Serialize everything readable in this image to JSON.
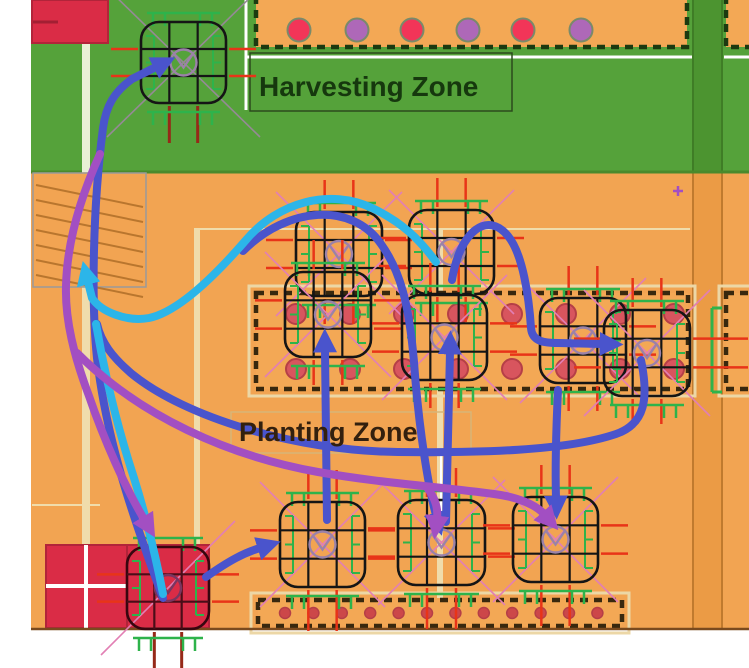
{
  "labels": {
    "harvesting": "Harvesting Zone",
    "planting": "Planting Zone"
  },
  "palette": {
    "white": "#ffffff",
    "green_bg": "#55a23a",
    "orange_bg": "#f2a452",
    "track_green": "#4c9430",
    "track_orange": "#eb9b45",
    "track_edge_green": "#3f7d26",
    "track_edge_orange": "#c07a2e",
    "zone_divider": "#4a8a2c",
    "map_bottom_edge": "#7a4a1e",
    "red_square": "#da2c46",
    "red_square_edge": "#b2243a",
    "red_square_dash": "#a31f33",
    "bed_dash": "#38280e",
    "bed_dash_green": "#1c3a10",
    "bed_frame": "#ecd7a6",
    "bed_fill": "#f3a855",
    "dot_red": "#f23558",
    "dot_purple": "#ae68b8",
    "dot_ring": "#7a8a6a",
    "bed_dot": "#d8555e",
    "bed_dot_ring": "#b53f47",
    "bed_dot_small": "#cc4749",
    "robot_line": "#151515",
    "robot_line_red": "#38060f",
    "robot_grid_red": "#4a0d18",
    "circle_gray": "#9b82a8",
    "diag_gray": "#958a95",
    "diag_pink": "#e27fb4",
    "tick_green": "#2eb34b",
    "tick_red": "#e83418",
    "tick_darkred": "#962918",
    "cream": "#f0dcab",
    "cream_light": "#e9f0d6",
    "hatch_line": "#b9762e",
    "hatch_edge": "#9a9a9a",
    "label_box_green": "#2c4a1c",
    "label_box_tan": "#d8b578",
    "path_blue": "#4a54cc",
    "path_cyan": "#2cb5e9",
    "path_purple": "#a24fc2"
  },
  "geometry": {
    "canvas": {
      "w": 749,
      "h": 668
    },
    "map": {
      "x": 31,
      "y": 0,
      "w": 718,
      "h": 630
    },
    "green_zone": {
      "x": 31,
      "y": 0,
      "w": 718,
      "h": 172
    },
    "track_column": {
      "x": 693,
      "w": 29
    },
    "hatch": {
      "x": 33,
      "y": 173,
      "w": 113,
      "h": 114,
      "lines": 7
    },
    "harvest_label_box": {
      "x": 250,
      "y": 53,
      "w": 262,
      "h": 58
    },
    "plant_label_box": {
      "x": 231,
      "y": 412,
      "w": 240,
      "h": 41
    },
    "red_squares": [
      {
        "x": 32,
        "y": 0,
        "w": 76,
        "h": 43
      },
      {
        "x": 46,
        "y": 545,
        "w": 81,
        "h": 83
      },
      {
        "x": 127,
        "y": 545,
        "w": 82,
        "h": 83
      }
    ],
    "red_square_dash_line": {
      "x1": 33,
      "y1": 22,
      "x2": 58,
      "y2": 22
    },
    "cream_strips": [
      {
        "x": 82,
        "y": 0,
        "w": 8,
        "h": 172,
        "c": "cream_light"
      },
      {
        "x": 82,
        "y": 172,
        "w": 8,
        "h": 375,
        "c": "cream"
      },
      {
        "x": 194,
        "y": 228,
        "w": 6,
        "h": 320,
        "c": "cream"
      },
      {
        "x": 437,
        "y": 230,
        "w": 6,
        "h": 368,
        "c": "cream"
      }
    ],
    "cream_lines": [
      {
        "x1": 196,
        "y1": 229,
        "x2": 690,
        "y2": 229
      },
      {
        "x1": 32,
        "y1": 505,
        "x2": 100,
        "y2": 505
      }
    ],
    "white_lines": [
      {
        "x1": 246,
        "y1": 0,
        "x2": 246,
        "y2": 110,
        "w": 3
      },
      {
        "x1": 246,
        "y1": 57,
        "x2": 692,
        "y2": 57,
        "w": 3
      },
      {
        "x1": 724,
        "y1": 57,
        "x2": 749,
        "y2": 57,
        "w": 3
      },
      {
        "x1": 86,
        "y1": 545,
        "x2": 86,
        "y2": 628,
        "w": 4
      },
      {
        "x1": 46,
        "y1": 586,
        "x2": 127,
        "y2": 586,
        "w": 4
      },
      {
        "x1": 441,
        "y1": 455,
        "x2": 441,
        "y2": 520,
        "w": 2
      }
    ],
    "beds": {
      "top": {
        "x": 256,
        "y": -14,
        "w": 431,
        "h": 61
      },
      "top_right": {
        "x": 726,
        "y": -14,
        "w": 46,
        "h": 61
      },
      "mid": {
        "x": 256,
        "y": 293,
        "w": 432,
        "h": 96
      },
      "mid_right": {
        "x": 726,
        "y": 293,
        "w": 40,
        "h": 96
      },
      "bottom": {
        "x": 258,
        "y": 600,
        "w": 364,
        "h": 26
      }
    },
    "top_dots": {
      "y": 30,
      "r": 11.5,
      "items": [
        {
          "x": 299,
          "c": "red"
        },
        {
          "x": 357,
          "c": "purple"
        },
        {
          "x": 412,
          "c": "red"
        },
        {
          "x": 468,
          "c": "purple"
        },
        {
          "x": 523,
          "c": "red"
        },
        {
          "x": 581,
          "c": "purple"
        }
      ]
    },
    "mid_dots": {
      "rows": [
        314,
        369
      ],
      "xs": [
        296,
        350,
        404,
        458,
        512,
        566,
        620,
        674
      ],
      "r": 10
    },
    "bottom_dots": {
      "y": 613,
      "r": 5.5,
      "x0": 285,
      "step": 28.4,
      "n": 12
    },
    "purple_plus": {
      "x": 678,
      "y": 191
    },
    "extra_green_bracket": {
      "x": 712,
      "y1": 308,
      "y2": 392
    },
    "robots": [
      {
        "x": 141,
        "y": 22,
        "w": 85,
        "h": 81,
        "variant": "field",
        "diag": "x",
        "dcol": "gray",
        "dlen": 34,
        "above": 0,
        "below": "dark"
      },
      {
        "x": 296,
        "y": 212,
        "w": 86,
        "h": 84,
        "variant": "field",
        "diag": "x",
        "dcol": "pink",
        "dlen": 20,
        "above": 1,
        "below": 28
      },
      {
        "x": 409,
        "y": 210,
        "w": 85,
        "h": 84,
        "variant": "field",
        "diag": "x",
        "dcol": "pink",
        "dlen": 20,
        "above": 1,
        "below": 28
      },
      {
        "x": 285,
        "y": 272,
        "w": 86,
        "h": 85,
        "variant": "field",
        "diag": "x",
        "dcol": "pink",
        "dlen": 20,
        "above": 1,
        "below": 28
      },
      {
        "x": 402,
        "y": 295,
        "w": 85,
        "h": 85,
        "variant": "field",
        "diag": "x",
        "dcol": "pink",
        "dlen": 20,
        "above": 1,
        "below": 28
      },
      {
        "x": 540,
        "y": 298,
        "w": 86,
        "h": 85,
        "variant": "field",
        "diag": "x",
        "dcol": "pink",
        "dlen": 20,
        "above": 1,
        "below": 28
      },
      {
        "x": 604,
        "y": 310,
        "w": 86,
        "h": 86,
        "variant": "field",
        "diag": "x",
        "dcol": "pink",
        "dlen": 20,
        "above": 1,
        "below": 28,
        "rt": 58
      },
      {
        "x": 280,
        "y": 502,
        "w": 85,
        "h": 85,
        "variant": "field",
        "diag": "x",
        "dcol": "pink",
        "dlen": 20,
        "above": 1,
        "below": 44
      },
      {
        "x": 398,
        "y": 500,
        "w": 87,
        "h": 85,
        "variant": "field",
        "diag": "x",
        "dcol": "pink",
        "dlen": 20,
        "above": 1,
        "below": 44
      },
      {
        "x": 513,
        "y": 497,
        "w": 85,
        "h": 85,
        "variant": "field",
        "diag": "x",
        "dcol": "pink",
        "dlen": 20,
        "above": 1,
        "below": 44
      },
      {
        "x": 127,
        "y": 547,
        "w": 82,
        "h": 82,
        "variant": "red",
        "diag": "slash",
        "dcol": "pink",
        "dlen": 26,
        "above": 0,
        "below": "dark"
      }
    ],
    "paths": [
      {
        "c": "blue",
        "d": "M 243 251 C 288 206 352 202 381 244 C 401 272 409 305 414 362 C 419 432 429 490 436 515",
        "m": 1
      },
      {
        "c": "blue",
        "d": "M 452 280 C 460 230 488 211 508 236 C 523 254 529 298 531 328 C 532 342 545 343 558 343 L 602 344",
        "m": 1
      },
      {
        "c": "blue",
        "d": "M 641 360 C 649 399 645 424 616 434 C 566 451 478 453 398 452 C 295 451 185 417 132 374 C 112 357 101 342 97 324",
        "m": 0
      },
      {
        "c": "blue",
        "d": "M 558 390 C 556 432 555 465 556 498",
        "m": 1
      },
      {
        "c": "blue",
        "d": "M 163 598 C 132 515 106 438 97 358 C 91 300 93 205 103 128 C 106 106 114 92 132 79 L 156 67",
        "m": 1
      },
      {
        "c": "blue",
        "d": "M 206 577 C 230 560 244 553 260 548",
        "m": 1
      },
      {
        "c": "blue",
        "d": "M 327 520 L 325 350",
        "m": 1
      },
      {
        "c": "blue",
        "d": "M 446 522 L 450 352",
        "m": 1
      },
      {
        "c": "cyan",
        "d": "M 436 262 C 420 240 402 222 372 208 C 330 188 278 202 246 240 C 214 277 178 312 149 318 C 127 322 101 312 92 298 L 88 282",
        "m": 1
      },
      {
        "c": "cyan",
        "d": "M 96 324 C 106 382 119 432 134 478 C 144 510 153 546 159 574 L 163 594",
        "m": 0
      },
      {
        "c": "purple",
        "d": "M 100 154 C 81 196 67 242 66 286 C 65 320 74 356 89 396 C 104 440 126 489 144 519",
        "m": 1
      },
      {
        "c": "purple",
        "d": "M 77 353 C 140 416 228 456 318 472 C 380 483 442 487 494 494 C 518 497 536 505 544 514",
        "m": 1
      },
      {
        "c": "purple",
        "d": "M 428 489 C 436 499 438 510 437 518",
        "m": 1
      }
    ]
  }
}
